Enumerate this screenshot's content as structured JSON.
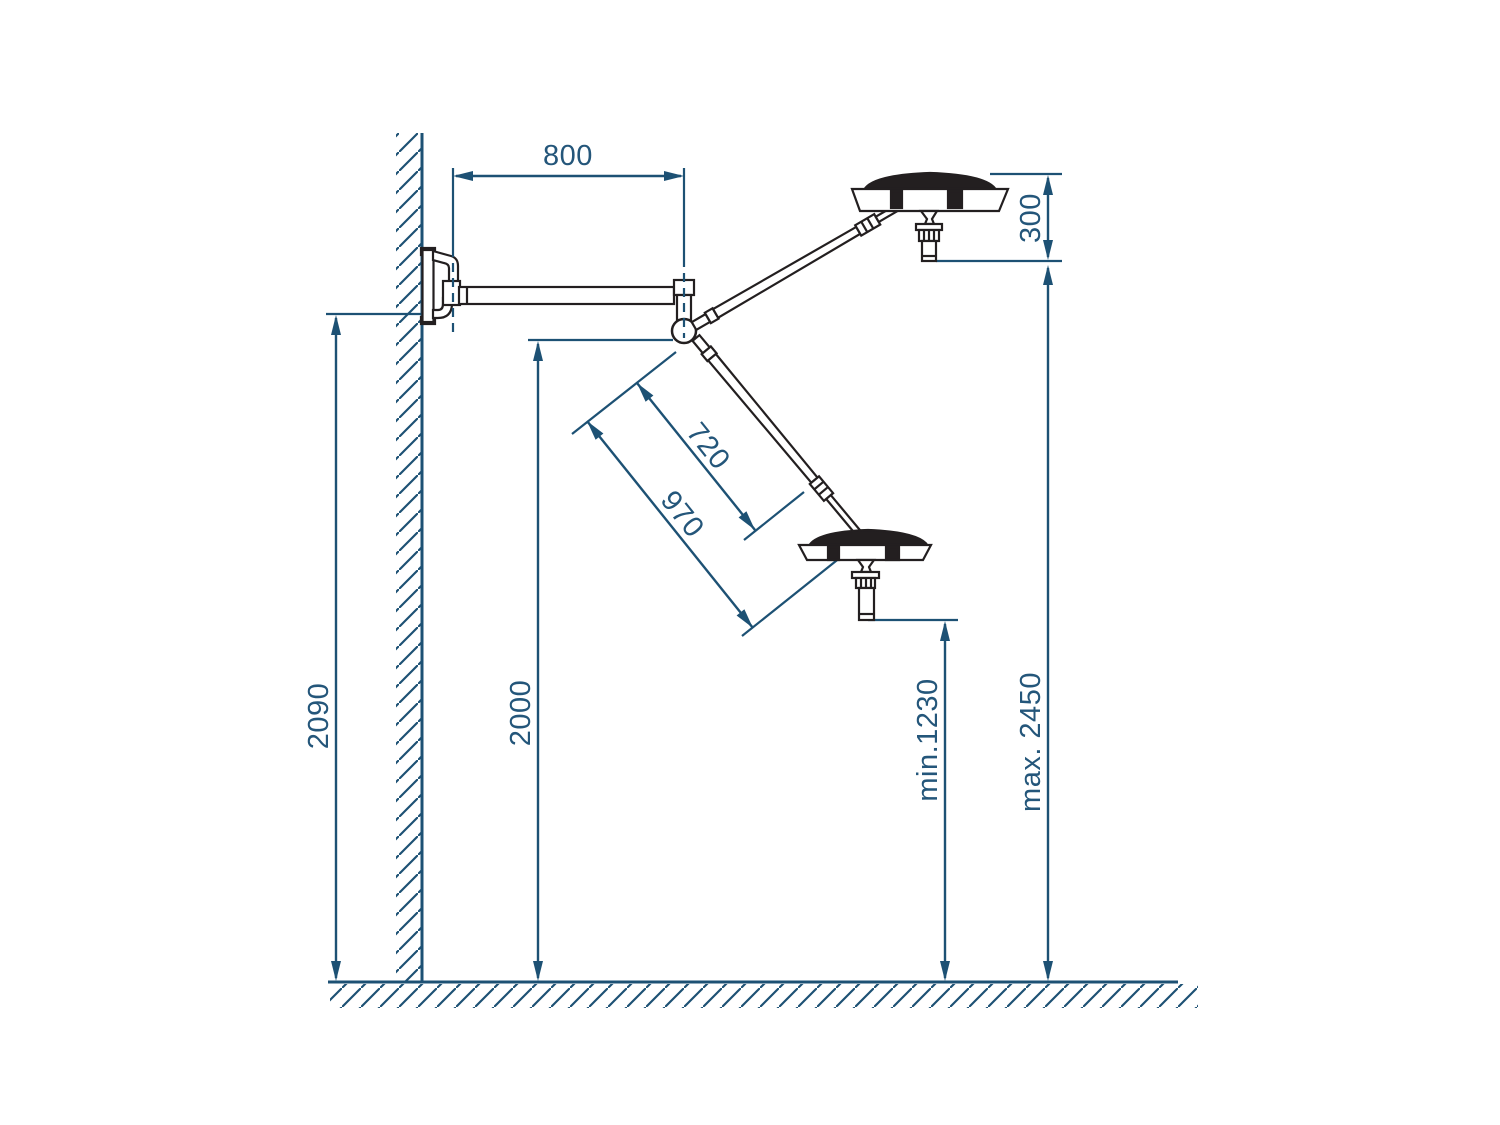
{
  "drawing": {
    "description": "Side elevation of a wall-mounted twin examination light with dimension lines",
    "colors": {
      "dimension_blue": "#1d5174",
      "label_blue": "#24567a",
      "drawing_black": "#231f20",
      "background": "#ffffff"
    },
    "labels": {
      "horizontal_arm": "800",
      "head_drop": "300",
      "bracket_height": "2090",
      "pivot_height": "2000",
      "spring_arm_inner": "720",
      "spring_arm_outer": "970",
      "min_height": "min.1230",
      "max_height": "max. 2450"
    },
    "parts": [
      "wall",
      "floor",
      "wall-bracket",
      "horizontal-support-arm",
      "central-pivot-hub",
      "upper-spring-arm",
      "lower-spring-arm",
      "upper-light-head",
      "lower-light-head"
    ]
  }
}
